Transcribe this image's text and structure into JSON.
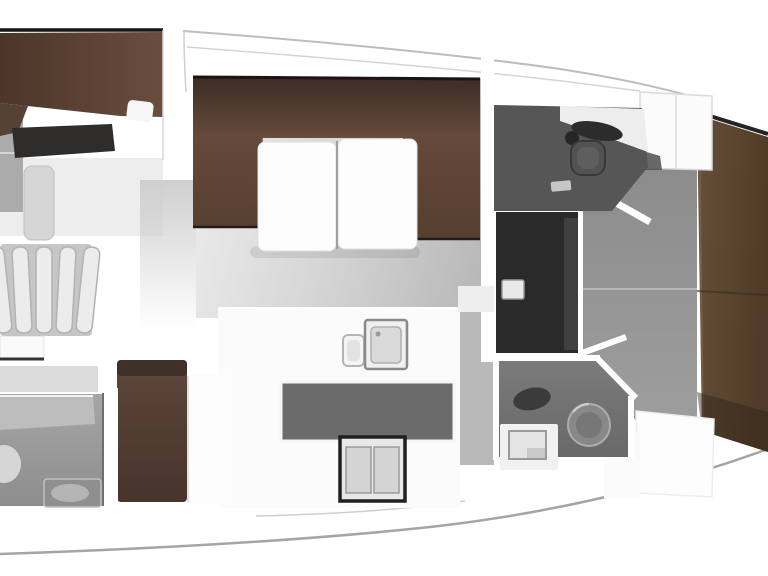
{
  "meta": {
    "type": "yacht-interior-floor-plan",
    "canvas": {
      "width_px": 768,
      "height_px": 576
    }
  },
  "colors": {
    "background": "#ffffff",
    "hull_line": "#a5a5a5",
    "deck_line": "#bdbdbd",
    "deck_line_inner": "#d4d4d4",
    "edge_dark": "#1c1410",
    "brown_settee_dark": "#3c2d26",
    "brown_settee": "#553f30",
    "brown_settee_light": "#65493a",
    "brown_aft_berth_l": "#4b3629",
    "brown_aft_berth_r": "#6a4d3d",
    "brown_bow_berth_l": "#66503a",
    "brown_bow_berth_r": "#503b28",
    "brown_seat": "#554136",
    "dark_wardrobe": "#2f2d2c",
    "dark_shower": "#2a2a2a",
    "head_floor": "#565656",
    "head2_floor": "#717171",
    "passage_gray": "#949494",
    "salon_floor_light": "#efefef",
    "salon_floor_dark": "#b9b9b9",
    "galley_well": "#6b6b6b",
    "counter_white": "#fbfbfb",
    "table_white": "#fdfdfd",
    "step_tread": "#ececec",
    "step_back": "#c6c6c6",
    "fixture_light": "#d6d6d6",
    "fixture_mid": "#9c9c9c",
    "toilet_gray": "#888888",
    "basin_dark": "#3b3b3b"
  },
  "areas": [
    {
      "id": "aft-cabin",
      "furniture": [
        "double-berth",
        "pillow",
        "wardrobe",
        "locker"
      ]
    },
    {
      "id": "companionway",
      "furniture": [
        "steps"
      ]
    },
    {
      "id": "nav-station",
      "furniture": [
        "desk",
        "seat-bench"
      ]
    },
    {
      "id": "aft-head",
      "furniture": [
        "toilet",
        "sink-counter"
      ]
    },
    {
      "id": "salon",
      "furniture": [
        "u-settee",
        "folding-table"
      ]
    },
    {
      "id": "galley",
      "furniture": [
        "sink",
        "cutting-module",
        "stove",
        "floor-well"
      ]
    },
    {
      "id": "corridor",
      "furniture": []
    },
    {
      "id": "forward-head",
      "furniture": [
        "counter",
        "basin",
        "toilet",
        "floor-mat"
      ]
    },
    {
      "id": "shower",
      "furniture": [
        "seat"
      ]
    },
    {
      "id": "forward-head-2",
      "furniture": [
        "basin",
        "toilet",
        "sink-counter"
      ]
    },
    {
      "id": "bow-cabin",
      "furniture": [
        "v-berth",
        "cabinets",
        "step-blocks"
      ]
    }
  ]
}
